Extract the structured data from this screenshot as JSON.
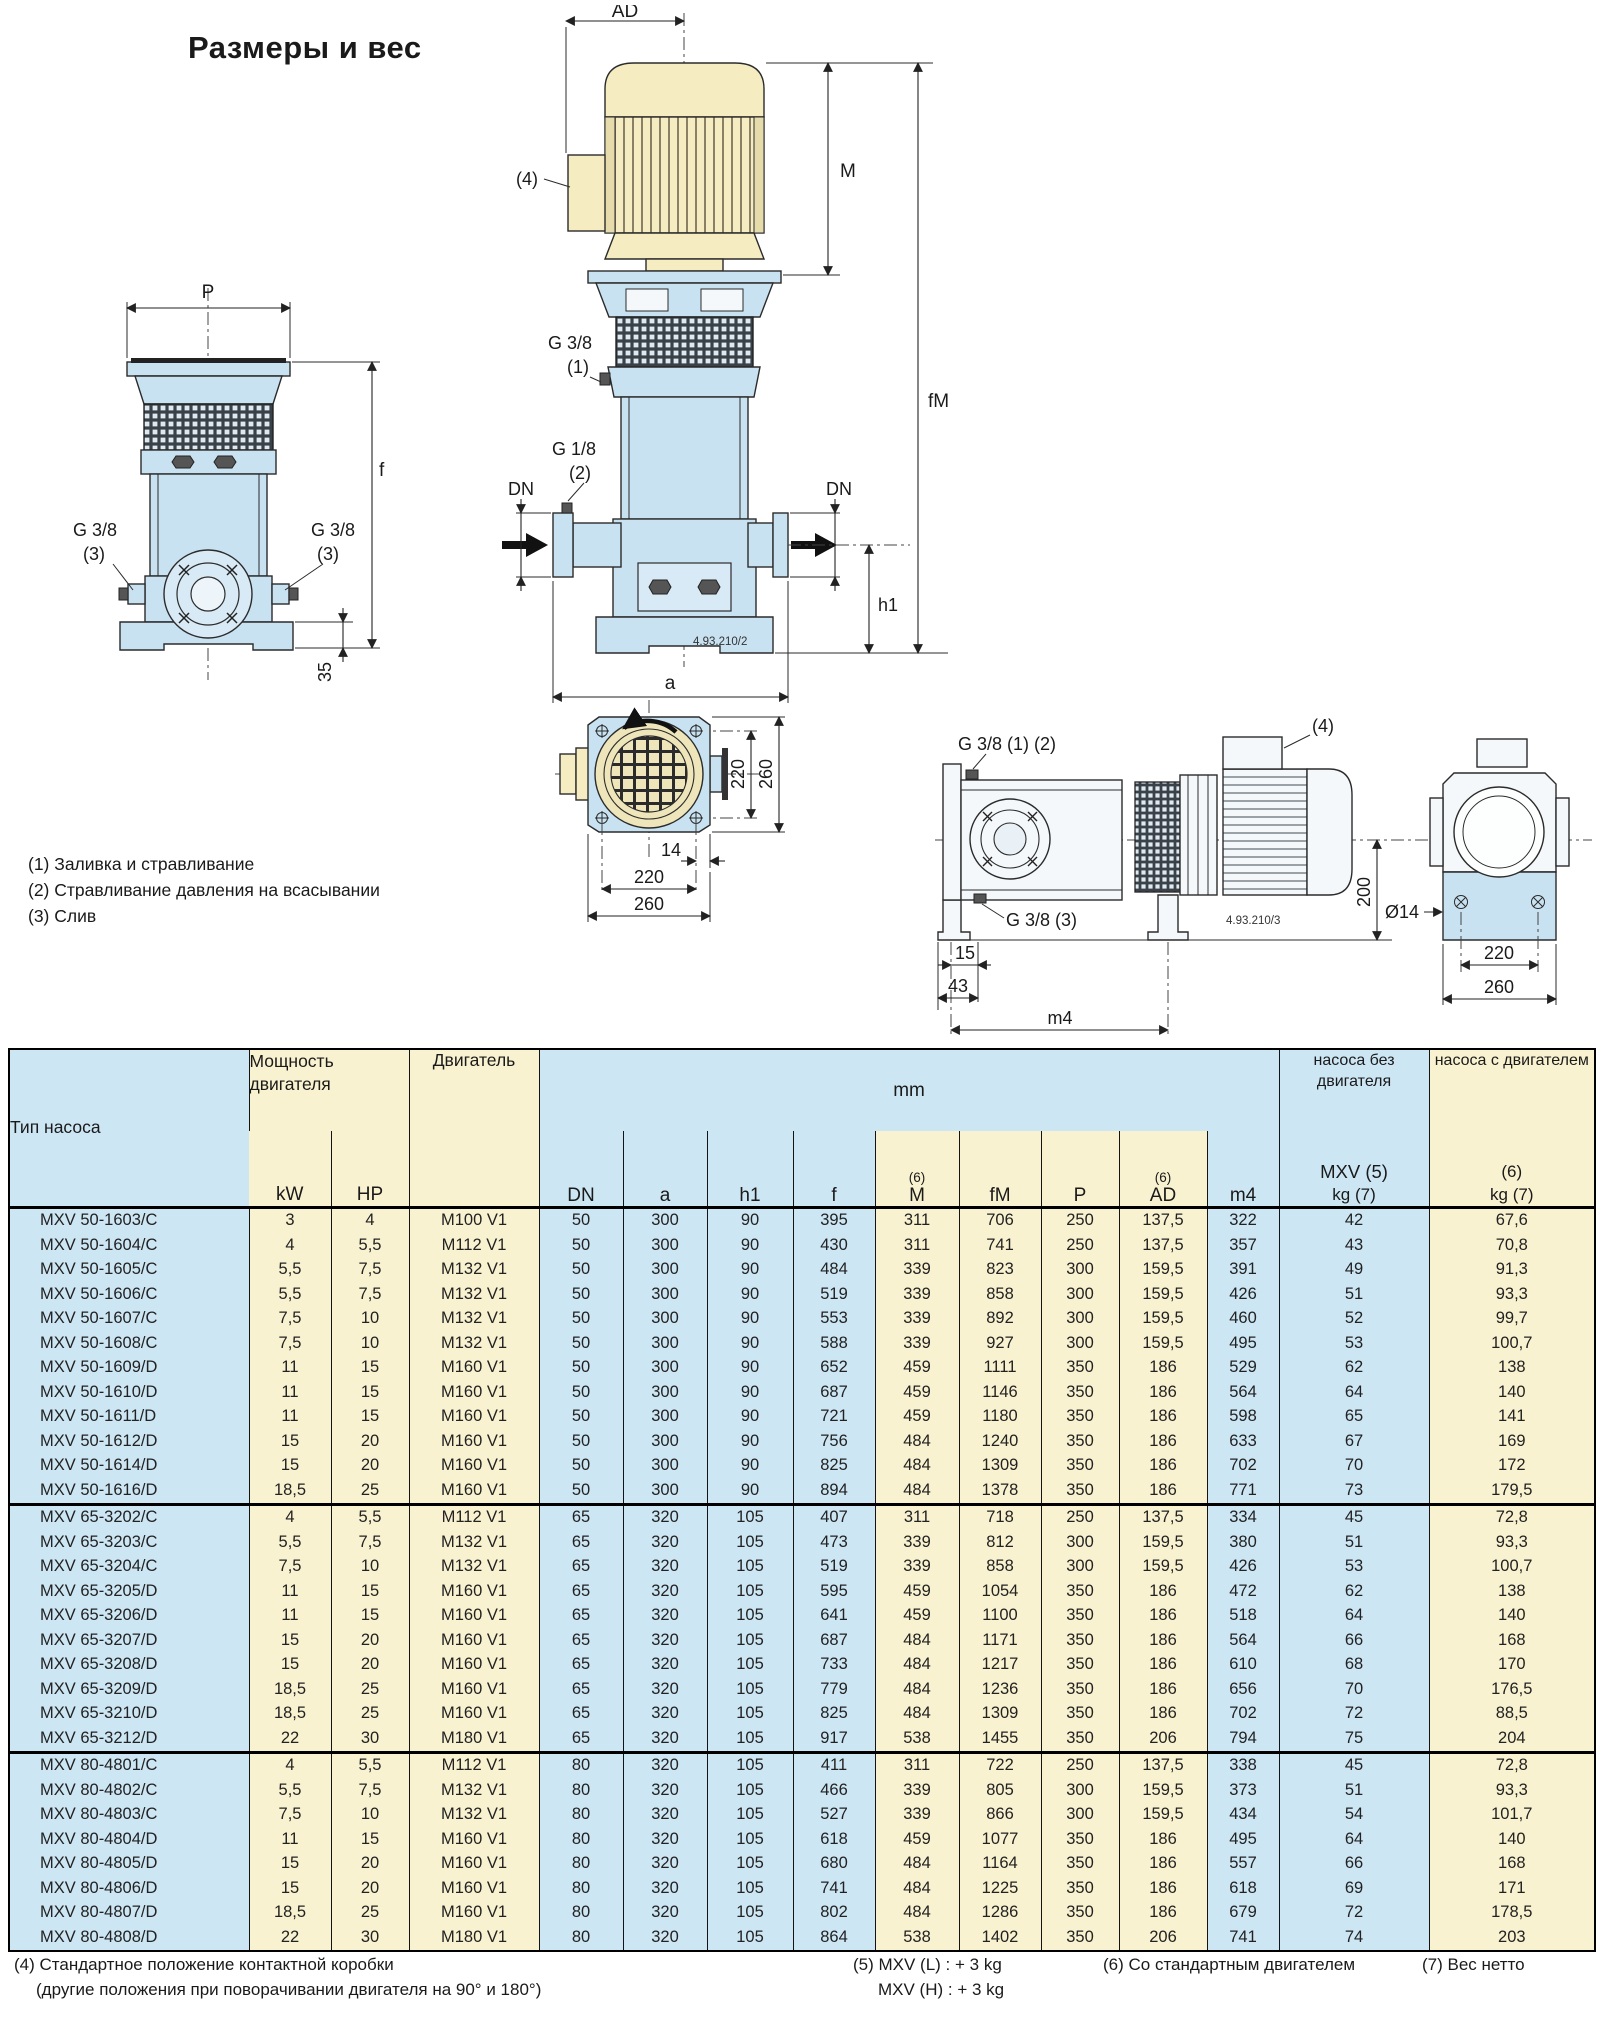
{
  "title": "Размеры и вес",
  "colors": {
    "table_blue": "#cde6f4",
    "table_yellow": "#f9f2d0",
    "drawing_blue": "#c9e2f1",
    "drawing_cream": "#f5ecc2"
  },
  "labels": {
    "ad": "AD",
    "m": "M",
    "fm": "fM",
    "p": "P",
    "f": "f",
    "a": "a",
    "h1": "h1",
    "dn": "DN",
    "m4": "m4",
    "d35": "35",
    "d220": "220",
    "d260": "260",
    "d14": "14",
    "d15": "15",
    "d43": "43",
    "d200": "200",
    "dia14": "Ø14",
    "g38": "G 3/8",
    "g18": "G 1/8",
    "n1": "(1)",
    "n2": "(2)",
    "n3": "(3)",
    "n4": "(4)",
    "g38_12": "G 3/8 (1) (2)",
    "g38_3": "G 3/8 (3)",
    "code2": "4.93.210/2",
    "code3": "4.93.210/3"
  },
  "notes": {
    "items": [
      "(1) Заливка и стравливание",
      "(2) Стравливание давления на всасывании",
      "(3) Слив"
    ]
  },
  "table": {
    "header": {
      "type": "Тип насоса",
      "power": "Мощность двигателя",
      "kw": "kW",
      "hp": "HP",
      "motor": "Двигатель",
      "mm": "mm",
      "sup6": "(6)",
      "cols": [
        "DN",
        "a",
        "h1",
        "f",
        "M",
        "fM",
        "P",
        "AD",
        "m4"
      ],
      "weight_pump": "насоса без двигателя",
      "weight_pump_line1": "MXV (5)",
      "weight_pump_line2": "kg (7)",
      "weight_with_motor": "насоса с двигателем",
      "weight_with_motor_line1": "(6)",
      "weight_with_motor_line2": "kg (7)"
    },
    "groups": [
      {
        "rows": [
          [
            "MXV 50-1603/C",
            "3",
            "4",
            "M100 V1",
            "50",
            "300",
            "90",
            "395",
            "311",
            "706",
            "250",
            "137,5",
            "322",
            "42",
            "67,6"
          ],
          [
            "MXV 50-1604/C",
            "4",
            "5,5",
            "M112 V1",
            "50",
            "300",
            "90",
            "430",
            "311",
            "741",
            "250",
            "137,5",
            "357",
            "43",
            "70,8"
          ],
          [
            "MXV 50-1605/C",
            "5,5",
            "7,5",
            "M132 V1",
            "50",
            "300",
            "90",
            "484",
            "339",
            "823",
            "300",
            "159,5",
            "391",
            "49",
            "91,3"
          ],
          [
            "MXV 50-1606/C",
            "5,5",
            "7,5",
            "M132 V1",
            "50",
            "300",
            "90",
            "519",
            "339",
            "858",
            "300",
            "159,5",
            "426",
            "51",
            "93,3"
          ],
          [
            "MXV 50-1607/C",
            "7,5",
            "10",
            "M132 V1",
            "50",
            "300",
            "90",
            "553",
            "339",
            "892",
            "300",
            "159,5",
            "460",
            "52",
            "99,7"
          ],
          [
            "MXV 50-1608/C",
            "7,5",
            "10",
            "M132 V1",
            "50",
            "300",
            "90",
            "588",
            "339",
            "927",
            "300",
            "159,5",
            "495",
            "53",
            "100,7"
          ],
          [
            "MXV 50-1609/D",
            "11",
            "15",
            "M160 V1",
            "50",
            "300",
            "90",
            "652",
            "459",
            "1111",
            "350",
            "186",
            "529",
            "62",
            "138"
          ],
          [
            "MXV 50-1610/D",
            "11",
            "15",
            "M160 V1",
            "50",
            "300",
            "90",
            "687",
            "459",
            "1146",
            "350",
            "186",
            "564",
            "64",
            "140"
          ],
          [
            "MXV 50-1611/D",
            "11",
            "15",
            "M160 V1",
            "50",
            "300",
            "90",
            "721",
            "459",
            "1180",
            "350",
            "186",
            "598",
            "65",
            "141"
          ],
          [
            "MXV 50-1612/D",
            "15",
            "20",
            "M160 V1",
            "50",
            "300",
            "90",
            "756",
            "484",
            "1240",
            "350",
            "186",
            "633",
            "67",
            "169"
          ],
          [
            "MXV 50-1614/D",
            "15",
            "20",
            "M160 V1",
            "50",
            "300",
            "90",
            "825",
            "484",
            "1309",
            "350",
            "186",
            "702",
            "70",
            "172"
          ],
          [
            "MXV 50-1616/D",
            "18,5",
            "25",
            "M160 V1",
            "50",
            "300",
            "90",
            "894",
            "484",
            "1378",
            "350",
            "186",
            "771",
            "73",
            "179,5"
          ]
        ]
      },
      {
        "rows": [
          [
            "MXV 65-3202/C",
            "4",
            "5,5",
            "M112 V1",
            "65",
            "320",
            "105",
            "407",
            "311",
            "718",
            "250",
            "137,5",
            "334",
            "45",
            "72,8"
          ],
          [
            "MXV 65-3203/C",
            "5,5",
            "7,5",
            "M132 V1",
            "65",
            "320",
            "105",
            "473",
            "339",
            "812",
            "300",
            "159,5",
            "380",
            "51",
            "93,3"
          ],
          [
            "MXV 65-3204/C",
            "7,5",
            "10",
            "M132 V1",
            "65",
            "320",
            "105",
            "519",
            "339",
            "858",
            "300",
            "159,5",
            "426",
            "53",
            "100,7"
          ],
          [
            "MXV 65-3205/D",
            "11",
            "15",
            "M160 V1",
            "65",
            "320",
            "105",
            "595",
            "459",
            "1054",
            "350",
            "186",
            "472",
            "62",
            "138"
          ],
          [
            "MXV 65-3206/D",
            "11",
            "15",
            "M160 V1",
            "65",
            "320",
            "105",
            "641",
            "459",
            "1100",
            "350",
            "186",
            "518",
            "64",
            "140"
          ],
          [
            "MXV 65-3207/D",
            "15",
            "20",
            "M160 V1",
            "65",
            "320",
            "105",
            "687",
            "484",
            "1171",
            "350",
            "186",
            "564",
            "66",
            "168"
          ],
          [
            "MXV 65-3208/D",
            "15",
            "20",
            "M160 V1",
            "65",
            "320",
            "105",
            "733",
            "484",
            "1217",
            "350",
            "186",
            "610",
            "68",
            "170"
          ],
          [
            "MXV 65-3209/D",
            "18,5",
            "25",
            "M160 V1",
            "65",
            "320",
            "105",
            "779",
            "484",
            "1236",
            "350",
            "186",
            "656",
            "70",
            "176,5"
          ],
          [
            "MXV 65-3210/D",
            "18,5",
            "25",
            "M160 V1",
            "65",
            "320",
            "105",
            "825",
            "484",
            "1309",
            "350",
            "186",
            "702",
            "72",
            "88,5"
          ],
          [
            "MXV 65-3212/D",
            "22",
            "30",
            "M180 V1",
            "65",
            "320",
            "105",
            "917",
            "538",
            "1455",
            "350",
            "206",
            "794",
            "75",
            "204"
          ]
        ]
      },
      {
        "rows": [
          [
            "MXV 80-4801/C",
            "4",
            "5,5",
            "M112 V1",
            "80",
            "320",
            "105",
            "411",
            "311",
            "722",
            "250",
            "137,5",
            "338",
            "45",
            "72,8"
          ],
          [
            "MXV 80-4802/C",
            "5,5",
            "7,5",
            "M132 V1",
            "80",
            "320",
            "105",
            "466",
            "339",
            "805",
            "300",
            "159,5",
            "373",
            "51",
            "93,3"
          ],
          [
            "MXV 80-4803/C",
            "7,5",
            "10",
            "M132 V1",
            "80",
            "320",
            "105",
            "527",
            "339",
            "866",
            "300",
            "159,5",
            "434",
            "54",
            "101,7"
          ],
          [
            "MXV 80-4804/D",
            "11",
            "15",
            "M160 V1",
            "80",
            "320",
            "105",
            "618",
            "459",
            "1077",
            "350",
            "186",
            "495",
            "64",
            "140"
          ],
          [
            "MXV 80-4805/D",
            "15",
            "20",
            "M160 V1",
            "80",
            "320",
            "105",
            "680",
            "484",
            "1164",
            "350",
            "186",
            "557",
            "66",
            "168"
          ],
          [
            "MXV 80-4806/D",
            "15",
            "20",
            "M160 V1",
            "80",
            "320",
            "105",
            "741",
            "484",
            "1225",
            "350",
            "186",
            "618",
            "69",
            "171"
          ],
          [
            "MXV 80-4807/D",
            "18,5",
            "25",
            "M160 V1",
            "80",
            "320",
            "105",
            "802",
            "484",
            "1286",
            "350",
            "186",
            "679",
            "72",
            "178,5"
          ],
          [
            "MXV 80-4808/D",
            "22",
            "30",
            "M180 V1",
            "80",
            "320",
            "105",
            "864",
            "538",
            "1402",
            "350",
            "206",
            "741",
            "74",
            "203"
          ]
        ]
      }
    ]
  },
  "footnotes": {
    "f4_line1": "(4) Стандартное положение контактной коробки",
    "f4_line2": "(другие положения при поворачивании двигателя на 90° и 180°)",
    "f5_line1": "(5) MXV (L) : + 3 kg",
    "f5_line2": "MXV (H) : + 3 kg",
    "f6": "(6) Со стандартным двигателем",
    "f7": "(7) Вес нетто"
  }
}
